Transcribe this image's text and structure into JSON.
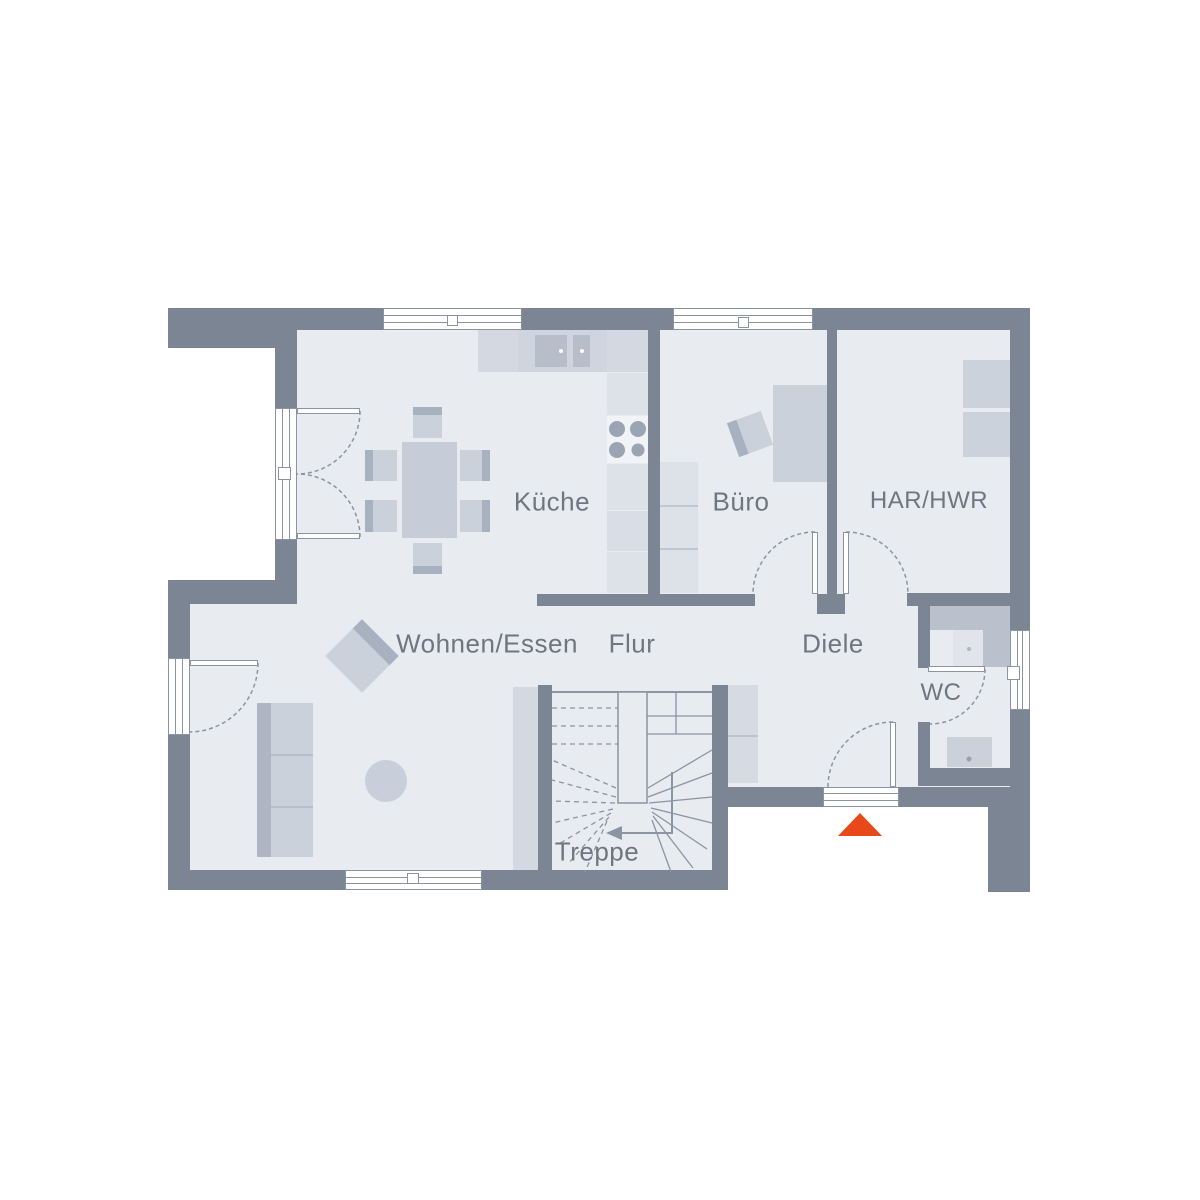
{
  "plan": {
    "type": "floor-plan",
    "level": "ground-floor"
  },
  "colors": {
    "wall": "#7b8594",
    "floor": "#e8ebf0",
    "furn": "#cbd1db",
    "furn_dark": "#a8b1bf",
    "furn_light": "#dde1e8",
    "counter": "#d3d8e1",
    "sink": "#b7bec9",
    "line": "#8b94a2",
    "text": "#6e7682",
    "accent": "#e8491a"
  },
  "rooms": [
    {
      "id": "wohnen-essen",
      "label": "Wohnen/Essen"
    },
    {
      "id": "kueche",
      "label": "Küche"
    },
    {
      "id": "buero",
      "label": "Büro"
    },
    {
      "id": "har-hwr",
      "label": "HAR/HWR"
    },
    {
      "id": "flur",
      "label": "Flur"
    },
    {
      "id": "diele",
      "label": "Diele"
    },
    {
      "id": "wc",
      "label": "WC"
    },
    {
      "id": "treppe",
      "label": "Treppe"
    }
  ],
  "markers": {
    "entrance": "entrance-triangle"
  }
}
